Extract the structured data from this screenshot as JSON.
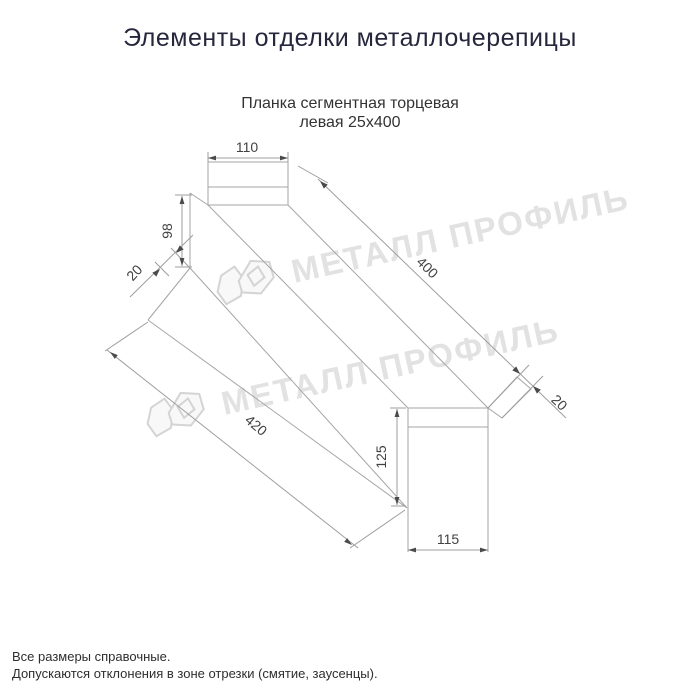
{
  "header": {
    "title": "Элементы отделки металлочерепицы"
  },
  "product": {
    "name_line1": "Планка сегментная торцевая",
    "name_line2": "левая 25х400"
  },
  "drawing": {
    "dims": {
      "top_width": "110",
      "left_end_height": "98",
      "left_fold": "20",
      "length_top": "400",
      "length_bottom": "420",
      "right_fold": "20",
      "right_end_height": "125",
      "bottom_width": "115"
    }
  },
  "watermark": {
    "text": "МЕТАЛЛ ПРОФИЛЬ",
    "color": "#e2e2e2"
  },
  "footer": {
    "note1": "Все размеры справочные.",
    "note2": "Допускаются отклонения в зоне отрезки (смятие, заусенцы)."
  },
  "colors": {
    "title_text": "#26263c",
    "drawing_line": "#a5a5a5",
    "dimension_line": "#9e9e9e",
    "dimension_text": "#424242",
    "arrow": "#4a4a4a"
  }
}
